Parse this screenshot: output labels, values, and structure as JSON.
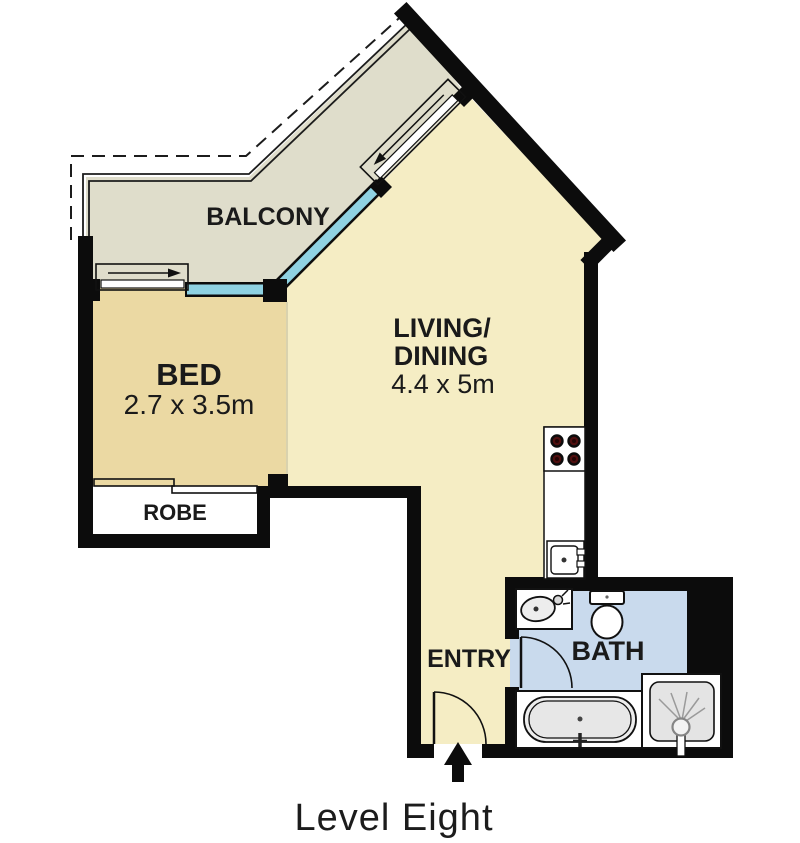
{
  "floor_plan": {
    "title": "Level Eight",
    "rooms": {
      "balcony": {
        "label": "BALCONY"
      },
      "bed": {
        "label": "BED",
        "dimensions": "2.7 x 3.5m"
      },
      "living": {
        "label_line1": "LIVING/",
        "label_line2": "DINING",
        "dimensions": "4.4 x 5m"
      },
      "robe": {
        "label": "ROBE"
      },
      "entry": {
        "label": "ENTRY"
      },
      "bath": {
        "label": "BATH"
      }
    },
    "fixtures": [
      "stove-icon",
      "kitchen-sink-icon",
      "basin-icon",
      "toilet-icon",
      "bathtub-icon",
      "shower-icon",
      "sliding-door-bed-icon",
      "sliding-door-balcony-icon",
      "entry-door-swing",
      "bath-door-swing",
      "entry-arrow-icon"
    ],
    "colors": {
      "balcony": "#dfddcb",
      "living": "#f5edc4",
      "bed": "#ebd9a3",
      "bath": "#c9daed",
      "window": "#8fd2e2",
      "wall": "#0c0c0c",
      "burner": "#4f0f0f",
      "text": "#1a1a1a"
    }
  }
}
